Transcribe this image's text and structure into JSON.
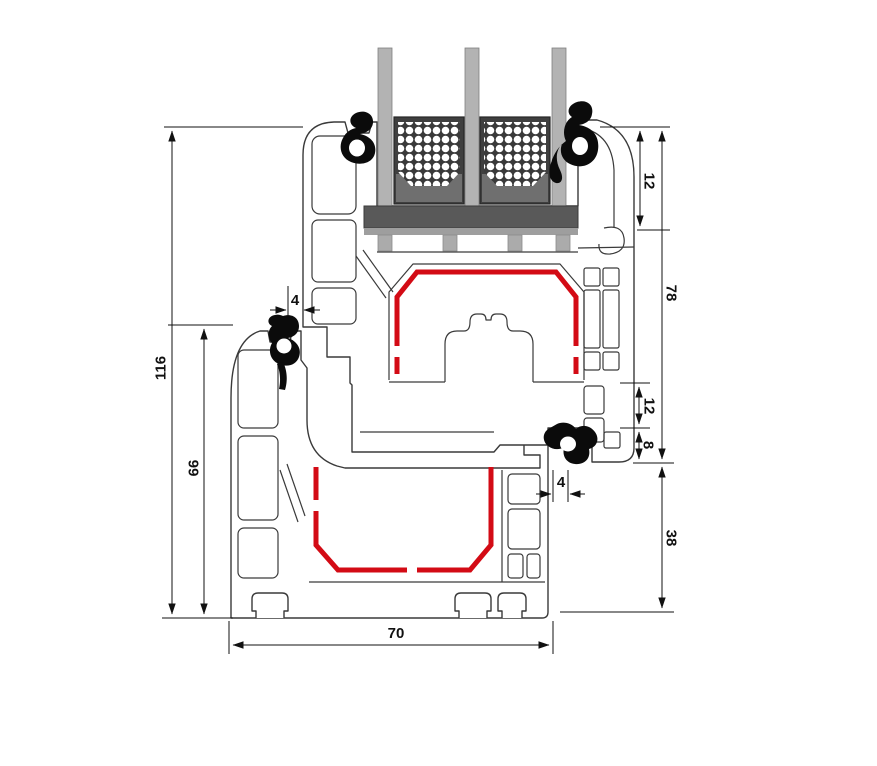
{
  "drawing": {
    "labels": {
      "height_total": "116",
      "height_frame": "66",
      "gap_left": "4",
      "bead_height": "12",
      "sash_height": "78",
      "step_upper": "12",
      "step_lower": "8",
      "gap_right": "4",
      "frame_lower": "38",
      "profile_depth": "70"
    },
    "colors": {
      "outline": "#3a3a3a",
      "dimension": "#111111",
      "reinforcement": "#d30b15",
      "glass": "#b3b3b3",
      "spacer": "#3f3f3f",
      "spacer_band": "#6f6f6f",
      "bridge": "#595959",
      "seat": "#9e9e9e",
      "gasket": "#0b0b0b"
    }
  }
}
